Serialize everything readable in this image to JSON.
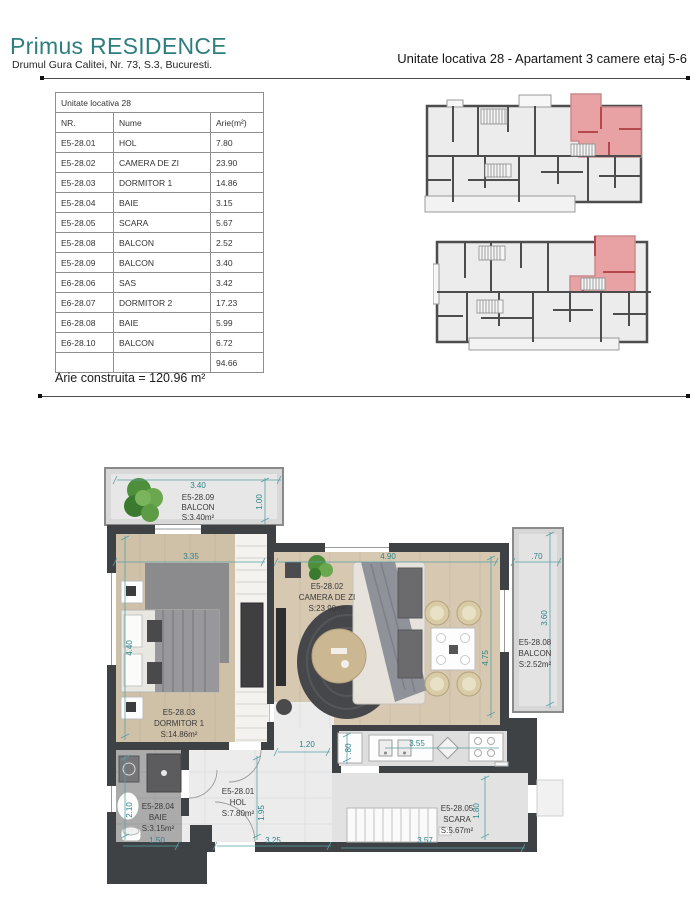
{
  "header": {
    "brand": "Primus RESIDENCE",
    "address": "Drumul Gura Calitei, Nr. 73, S.3, Bucuresti.",
    "unit_title": "Unitate locativa 28 -  Apartament 3 camere etaj 5-6"
  },
  "table": {
    "title": "Unitate locativa 28",
    "columns": [
      "NR.",
      "Nume",
      "Arie(m²)"
    ],
    "rows": [
      [
        "E5-28.01",
        "HOL",
        "7.80"
      ],
      [
        "E5-28.02",
        "CAMERA DE ZI",
        "23.90"
      ],
      [
        "E5-28.03",
        "DORMITOR 1",
        "14.86"
      ],
      [
        "E5-28.04",
        "BAIE",
        "3.15"
      ],
      [
        "E5-28.05",
        "SCARA",
        "5.67"
      ],
      [
        "E5-28.08",
        "BALCON",
        "2.52"
      ],
      [
        "E5-28.09",
        "BALCON",
        "3.40"
      ],
      [
        "E6-28.06",
        "SAS",
        "3.42"
      ],
      [
        "E6-28.07",
        "DORMITOR 2",
        "17.23"
      ],
      [
        "E6-28.08",
        "BAIE",
        "5.99"
      ],
      [
        "E6-28.10",
        "BALCON",
        "6.72"
      ]
    ],
    "total": "94.66",
    "footer": "Arie construita = 120.96 m²"
  },
  "plan": {
    "rooms": {
      "balcony_top": {
        "id": "E5-28.09",
        "name": "BALCON",
        "area": "S:3.40m²"
      },
      "dormitor1": {
        "id": "E5-28.03",
        "name": "DORMITOR 1",
        "area": "S:14.86m²"
      },
      "camera": {
        "id": "E5-28.02",
        "name": "CAMERA DE ZI",
        "area": "S:23.90m²"
      },
      "balcony_right": {
        "id": "E5-28.08",
        "name": "BALCON",
        "area": "S:2.52m²"
      },
      "baie": {
        "id": "E5-28.04",
        "name": "BAIE",
        "area": "S:3.15m²"
      },
      "hol": {
        "id": "E5-28.01",
        "name": "HOL",
        "area": "S:7.80m²"
      },
      "scara": {
        "id": "E5-28.05",
        "name": "SCARA",
        "area": "S:5.67m²"
      }
    },
    "dims": {
      "balcony_top_w": "3.40",
      "balcony_top_d": "1.00",
      "dorm_w": "3.35",
      "dorm_h": "4.40",
      "living_w": "4.90",
      "living_h": "4.75",
      "balc_r_w": ".70",
      "balc_r_h": "3.60",
      "pass_w": "1.20",
      "kitchen_d": ".80",
      "kitchen_w": "3.55",
      "baie_h": "2.10",
      "baie_w": "1.50",
      "hol_h": "1.95",
      "hol_w": "3.25",
      "scara_w": "3.57",
      "scara_h": "1.80"
    }
  },
  "colors": {
    "brand_teal": "#2e7d7f",
    "dimension_teal": "#2f8389",
    "apartment_highlight": "#e8a2a4",
    "wall_dark": "#3f4245"
  }
}
